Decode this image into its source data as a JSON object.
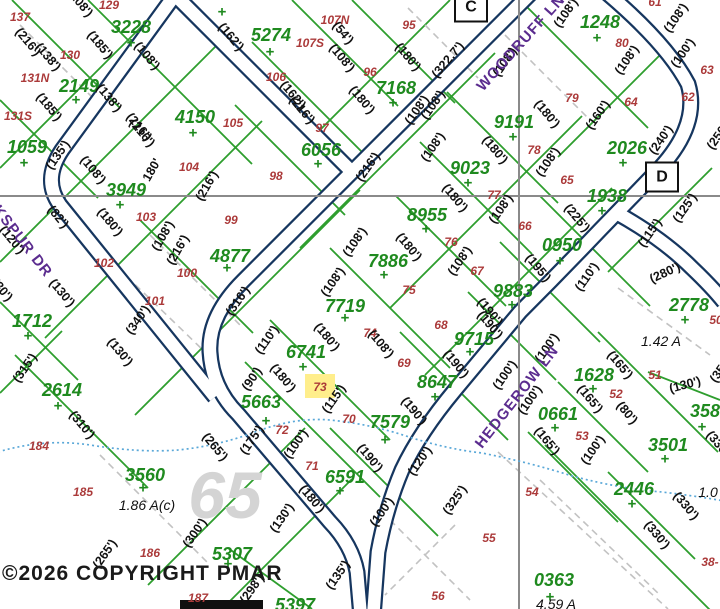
{
  "map": {
    "copyright": "©2026 COPYRIGHT PMAR",
    "watermark": {
      "t": "65",
      "x": 225,
      "y": 495
    },
    "highlighted_lot": "73",
    "colors": {
      "parcel_green_text": "#1f8a1f",
      "parcel_green_line": "#2e9e2e",
      "lot_red": "#ab3a3a",
      "street_purple": "#5b2c8f",
      "road_navy": "#16365f",
      "boundary_gray": "#8a8a8a",
      "stream_blue": "#5aa8d8",
      "highlight_yellow": "#ffee8c"
    },
    "grid_boxes": [
      {
        "t": "C",
        "x": 471,
        "y": 7
      },
      {
        "t": "D",
        "x": 662,
        "y": 177
      }
    ],
    "streets": [
      {
        "name": "WOODRUFF LN",
        "x": 521,
        "y": 43,
        "r": -48
      },
      {
        "name": "LARKSPUR DR",
        "x": 12,
        "y": 228,
        "r": 52
      },
      {
        "name": "HEDGEROW LN",
        "x": 517,
        "y": 397,
        "r": -52
      }
    ],
    "parcels": [
      {
        "n": "3228",
        "x": 131,
        "y": 27,
        "px": 131,
        "py": 43
      },
      {
        "n": "5274",
        "x": 271,
        "y": 35,
        "px": 270,
        "py": 52
      },
      {
        "n": "2149",
        "x": 79,
        "y": 86,
        "px": 76,
        "py": 100
      },
      {
        "n": "4150",
        "x": 195,
        "y": 117,
        "px": 193,
        "py": 133
      },
      {
        "n": "1059",
        "x": 27,
        "y": 147,
        "px": 24,
        "py": 163
      },
      {
        "n": "3949",
        "x": 126,
        "y": 190,
        "px": 120,
        "py": 205
      },
      {
        "n": "6056",
        "x": 321,
        "y": 150,
        "px": 318,
        "py": 164
      },
      {
        "n": "7168",
        "x": 396,
        "y": 88,
        "px": 393,
        "py": 103
      },
      {
        "n": "1248",
        "x": 600,
        "y": 22,
        "px": 597,
        "py": 38
      },
      {
        "n": "9191",
        "x": 514,
        "y": 122,
        "px": 513,
        "py": 137
      },
      {
        "n": "9023",
        "x": 470,
        "y": 168,
        "px": 468,
        "py": 183
      },
      {
        "n": "2026",
        "x": 627,
        "y": 148,
        "px": 623,
        "py": 163
      },
      {
        "n": "1938",
        "x": 607,
        "y": 196,
        "px": 602,
        "py": 211
      },
      {
        "n": "8955",
        "x": 427,
        "y": 215,
        "px": 426,
        "py": 229
      },
      {
        "n": "0950",
        "x": 562,
        "y": 245,
        "px": 560,
        "py": 261
      },
      {
        "n": "7886",
        "x": 388,
        "y": 261,
        "px": 384,
        "py": 275
      },
      {
        "n": "9883",
        "x": 513,
        "y": 291,
        "px": 512,
        "py": 305
      },
      {
        "n": "4877",
        "x": 230,
        "y": 256,
        "px": 227,
        "py": 268
      },
      {
        "n": "2778",
        "x": 689,
        "y": 305,
        "px": 685,
        "py": 320
      },
      {
        "n": "7719",
        "x": 345,
        "y": 306,
        "px": 345,
        "py": 318
      },
      {
        "n": "9715",
        "x": 474,
        "y": 339,
        "px": 470,
        "py": 352
      },
      {
        "n": "6741",
        "x": 306,
        "y": 352,
        "px": 303,
        "py": 367
      },
      {
        "n": "1712",
        "x": 32,
        "y": 321,
        "px": 28,
        "py": 336
      },
      {
        "n": "8647",
        "x": 437,
        "y": 382,
        "px": 435,
        "py": 397
      },
      {
        "n": "1628",
        "x": 594,
        "y": 375,
        "px": 593,
        "py": 389
      },
      {
        "n": "5663",
        "x": 261,
        "y": 402,
        "px": 266,
        "py": 421
      },
      {
        "n": "0661",
        "x": 558,
        "y": 414,
        "px": 555,
        "py": 428
      },
      {
        "n": "3587",
        "x": 710,
        "y": 411,
        "px": 702,
        "py": 427
      },
      {
        "n": "7579",
        "x": 390,
        "y": 422,
        "px": 385,
        "py": 440
      },
      {
        "n": "2614",
        "x": 62,
        "y": 390,
        "px": 58,
        "py": 406
      },
      {
        "n": "3501",
        "x": 668,
        "y": 445,
        "px": 665,
        "py": 459
      },
      {
        "n": "6591",
        "x": 345,
        "y": 477,
        "px": 340,
        "py": 491
      },
      {
        "n": "3560",
        "x": 145,
        "y": 475,
        "px": 143,
        "py": 488
      },
      {
        "n": "2446",
        "x": 634,
        "y": 489,
        "px": 632,
        "py": 504
      },
      {
        "n": "5307",
        "x": 232,
        "y": 554,
        "px": 228,
        "py": 564
      },
      {
        "n": "0363",
        "x": 554,
        "y": 580,
        "px": 550,
        "py": 597
      },
      {
        "n": "5397",
        "x": 295,
        "y": 605,
        "px": -50,
        "py": -50
      }
    ],
    "lone_plus_marks": [
      {
        "x": 222,
        "y": 12
      }
    ],
    "lots": [
      {
        "n": "137",
        "x": 20,
        "y": 17
      },
      {
        "n": "129",
        "x": 109,
        "y": 5
      },
      {
        "n": "130",
        "x": 70,
        "y": 55
      },
      {
        "n": "131N",
        "x": 35,
        "y": 78
      },
      {
        "n": "131S",
        "x": 18,
        "y": 116
      },
      {
        "n": "104",
        "x": 189,
        "y": 167
      },
      {
        "n": "103",
        "x": 146,
        "y": 217
      },
      {
        "n": "102",
        "x": 104,
        "y": 263
      },
      {
        "n": "101",
        "x": 155,
        "y": 301
      },
      {
        "n": "100",
        "x": 187,
        "y": 273
      },
      {
        "n": "99",
        "x": 231,
        "y": 220
      },
      {
        "n": "98",
        "x": 276,
        "y": 176
      },
      {
        "n": "97",
        "x": 322,
        "y": 128
      },
      {
        "n": "96",
        "x": 370,
        "y": 72
      },
      {
        "n": "95",
        "x": 409,
        "y": 25
      },
      {
        "n": "105",
        "x": 233,
        "y": 123
      },
      {
        "n": "106",
        "x": 276,
        "y": 77
      },
      {
        "n": "107N",
        "x": 335,
        "y": 20
      },
      {
        "n": "107S",
        "x": 310,
        "y": 43
      },
      {
        "n": "80",
        "x": 622,
        "y": 43
      },
      {
        "n": "79",
        "x": 572,
        "y": 98
      },
      {
        "n": "78",
        "x": 534,
        "y": 150
      },
      {
        "n": "77",
        "x": 494,
        "y": 195
      },
      {
        "n": "76",
        "x": 451,
        "y": 242
      },
      {
        "n": "75",
        "x": 409,
        "y": 290
      },
      {
        "n": "74",
        "x": 370,
        "y": 333
      },
      {
        "n": "73",
        "x": 320,
        "y": 387
      },
      {
        "n": "72",
        "x": 282,
        "y": 430
      },
      {
        "n": "71",
        "x": 312,
        "y": 466
      },
      {
        "n": "70",
        "x": 349,
        "y": 419
      },
      {
        "n": "69",
        "x": 404,
        "y": 363
      },
      {
        "n": "68",
        "x": 441,
        "y": 325
      },
      {
        "n": "67",
        "x": 477,
        "y": 271
      },
      {
        "n": "66",
        "x": 525,
        "y": 226
      },
      {
        "n": "65",
        "x": 567,
        "y": 180
      },
      {
        "n": "64",
        "x": 631,
        "y": 102
      },
      {
        "n": "63",
        "x": 707,
        "y": 70
      },
      {
        "n": "62",
        "x": 688,
        "y": 97
      },
      {
        "n": "61",
        "x": 655,
        "y": 2
      },
      {
        "n": "50",
        "x": 716,
        "y": 320
      },
      {
        "n": "51",
        "x": 655,
        "y": 375
      },
      {
        "n": "52",
        "x": 616,
        "y": 394
      },
      {
        "n": "53",
        "x": 582,
        "y": 436
      },
      {
        "n": "54",
        "x": 532,
        "y": 492
      },
      {
        "n": "55",
        "x": 489,
        "y": 538
      },
      {
        "n": "56",
        "x": 438,
        "y": 596
      },
      {
        "n": "184",
        "x": 39,
        "y": 446
      },
      {
        "n": "185",
        "x": 83,
        "y": 492
      },
      {
        "n": "186",
        "x": 150,
        "y": 553
      },
      {
        "n": "187",
        "x": 198,
        "y": 598
      },
      {
        "n": "38-",
        "x": 710,
        "y": 562
      }
    ],
    "dims": [
      {
        "t": "(216')",
        "x": 28,
        "y": 42,
        "r": 50
      },
      {
        "t": "(138')",
        "x": 48,
        "y": 57,
        "r": 50
      },
      {
        "t": "(185')",
        "x": 100,
        "y": 45,
        "r": 50
      },
      {
        "t": "(108')",
        "x": 147,
        "y": 56,
        "r": 50
      },
      {
        "t": "(185')",
        "x": 49,
        "y": 107,
        "r": 50
      },
      {
        "t": "(138')",
        "x": 109,
        "y": 98,
        "r": 50
      },
      {
        "t": "(216')",
        "x": 139,
        "y": 127,
        "r": 50
      },
      {
        "t": "(135')",
        "x": 58,
        "y": 155,
        "r": -55
      },
      {
        "t": "(108')",
        "x": 93,
        "y": 170,
        "r": 50
      },
      {
        "t": "180'",
        "x": 152,
        "y": 170,
        "r": -60
      },
      {
        "t": "(216')",
        "x": 207,
        "y": 186,
        "r": -60
      },
      {
        "t": "(216')",
        "x": 142,
        "y": 133,
        "r": 50
      },
      {
        "t": "(162')",
        "x": 231,
        "y": 37,
        "r": 50
      },
      {
        "t": "(108')",
        "x": 80,
        "y": 3,
        "r": 50
      },
      {
        "t": "(54')",
        "x": 343,
        "y": 33,
        "r": 50
      },
      {
        "t": "(108')",
        "x": 342,
        "y": 58,
        "r": 50
      },
      {
        "t": "(180')",
        "x": 408,
        "y": 57,
        "r": 50
      },
      {
        "t": "(180')",
        "x": 362,
        "y": 100,
        "r": 50
      },
      {
        "t": "(108')",
        "x": 417,
        "y": 110,
        "r": -55
      },
      {
        "t": "(162')",
        "x": 293,
        "y": 95,
        "r": 50
      },
      {
        "t": "(216')",
        "x": 302,
        "y": 110,
        "r": 50
      },
      {
        "t": "(216')",
        "x": 368,
        "y": 167,
        "r": -55
      },
      {
        "t": "(108')",
        "x": 433,
        "y": 147,
        "r": -55
      },
      {
        "t": "(120')",
        "x": 12,
        "y": 240,
        "r": 50
      },
      {
        "t": "(82')",
        "x": 58,
        "y": 217,
        "r": 50
      },
      {
        "t": "(180')",
        "x": 110,
        "y": 222,
        "r": 50
      },
      {
        "t": "(216')",
        "x": 178,
        "y": 250,
        "r": -60
      },
      {
        "t": "(108')",
        "x": 163,
        "y": 236,
        "r": -60
      },
      {
        "t": "(130')",
        "x": 62,
        "y": 293,
        "r": 50
      },
      {
        "t": "(340')",
        "x": 138,
        "y": 320,
        "r": -55
      },
      {
        "t": "(316')",
        "x": 238,
        "y": 301,
        "r": -55
      },
      {
        "t": "(130')",
        "x": 120,
        "y": 352,
        "r": 50
      },
      {
        "t": "(315')",
        "x": 25,
        "y": 368,
        "r": -55
      },
      {
        "t": "(310')",
        "x": 82,
        "y": 425,
        "r": 50
      },
      {
        "t": "(265')",
        "x": 215,
        "y": 447,
        "r": 50
      },
      {
        "t": "(30')",
        "x": 2,
        "y": 290,
        "r": 50
      },
      {
        "t": "(322.7')",
        "x": 448,
        "y": 60,
        "r": -50
      },
      {
        "t": "(108')",
        "x": 505,
        "y": 62,
        "r": -55
      },
      {
        "t": "(108')",
        "x": 566,
        "y": 13,
        "r": -55
      },
      {
        "t": "(108')",
        "x": 627,
        "y": 60,
        "r": -55
      },
      {
        "t": "(108')",
        "x": 676,
        "y": 18,
        "r": -55
      },
      {
        "t": "(100')",
        "x": 683,
        "y": 53,
        "r": -55
      },
      {
        "t": "(240')",
        "x": 661,
        "y": 140,
        "r": -55
      },
      {
        "t": "(250')",
        "x": 719,
        "y": 135,
        "r": -55
      },
      {
        "t": "(160')",
        "x": 598,
        "y": 115,
        "r": -55
      },
      {
        "t": "(180')",
        "x": 547,
        "y": 114,
        "r": 50
      },
      {
        "t": "(180')",
        "x": 495,
        "y": 150,
        "r": 50
      },
      {
        "t": "(108')",
        "x": 433,
        "y": 105,
        "r": -55
      },
      {
        "t": "(108')",
        "x": 548,
        "y": 162,
        "r": -55
      },
      {
        "t": "(180')",
        "x": 455,
        "y": 198,
        "r": 50
      },
      {
        "t": "(108')",
        "x": 501,
        "y": 209,
        "r": -55
      },
      {
        "t": "(180')",
        "x": 409,
        "y": 247,
        "r": 50
      },
      {
        "t": "(108')",
        "x": 460,
        "y": 261,
        "r": -55
      },
      {
        "t": "(225')",
        "x": 577,
        "y": 218,
        "r": 50
      },
      {
        "t": "(115')",
        "x": 650,
        "y": 233,
        "r": -55
      },
      {
        "t": "(125')",
        "x": 685,
        "y": 208,
        "r": -55
      },
      {
        "t": "(195')",
        "x": 538,
        "y": 268,
        "r": 50
      },
      {
        "t": "(110')",
        "x": 587,
        "y": 277,
        "r": -55
      },
      {
        "t": "(280')",
        "x": 665,
        "y": 273,
        "r": -25
      },
      {
        "t": "(190')",
        "x": 490,
        "y": 325,
        "r": 50
      },
      {
        "t": "(100')",
        "x": 547,
        "y": 348,
        "r": -55
      },
      {
        "t": "(100')",
        "x": 505,
        "y": 375,
        "r": -55
      },
      {
        "t": "(108')",
        "x": 355,
        "y": 242,
        "r": -55
      },
      {
        "t": "(108')",
        "x": 333,
        "y": 282,
        "r": -55
      },
      {
        "t": "(180')",
        "x": 327,
        "y": 337,
        "r": 50
      },
      {
        "t": "(110')",
        "x": 267,
        "y": 340,
        "r": -55
      },
      {
        "t": "(90')",
        "x": 252,
        "y": 379,
        "r": -55
      },
      {
        "t": "(180')",
        "x": 283,
        "y": 378,
        "r": 50
      },
      {
        "t": "(108')",
        "x": 381,
        "y": 344,
        "r": 50
      },
      {
        "t": "(190')",
        "x": 456,
        "y": 364,
        "r": 50
      },
      {
        "t": "(190')",
        "x": 490,
        "y": 312,
        "r": 50
      },
      {
        "t": "(190')",
        "x": 414,
        "y": 411,
        "r": 50
      },
      {
        "t": "(190')",
        "x": 370,
        "y": 458,
        "r": 50
      },
      {
        "t": "(115')",
        "x": 334,
        "y": 399,
        "r": -55
      },
      {
        "t": "(175')",
        "x": 252,
        "y": 440,
        "r": -55
      },
      {
        "t": "(100')",
        "x": 296,
        "y": 444,
        "r": -55
      },
      {
        "t": "(120')",
        "x": 420,
        "y": 461,
        "r": -55
      },
      {
        "t": "(325')",
        "x": 455,
        "y": 500,
        "r": -55
      },
      {
        "t": "(100')",
        "x": 382,
        "y": 512,
        "r": -55
      },
      {
        "t": "(130')",
        "x": 282,
        "y": 518,
        "r": -55
      },
      {
        "t": "(180')",
        "x": 312,
        "y": 499,
        "r": 50
      },
      {
        "t": "(135')",
        "x": 338,
        "y": 575,
        "r": -55
      },
      {
        "t": "(298')",
        "x": 252,
        "y": 589,
        "r": -55
      },
      {
        "t": "(265')",
        "x": 105,
        "y": 554,
        "r": -55
      },
      {
        "t": "(300')",
        "x": 195,
        "y": 533,
        "r": -55
      },
      {
        "t": "(165')",
        "x": 547,
        "y": 441,
        "r": 50
      },
      {
        "t": "(165')",
        "x": 620,
        "y": 365,
        "r": 50
      },
      {
        "t": "(165')",
        "x": 590,
        "y": 399,
        "r": 50
      },
      {
        "t": "(100')",
        "x": 593,
        "y": 450,
        "r": -55
      },
      {
        "t": "(100')",
        "x": 530,
        "y": 400,
        "r": -55
      },
      {
        "t": "(80')",
        "x": 627,
        "y": 413,
        "r": 50
      },
      {
        "t": "(130')",
        "x": 685,
        "y": 385,
        "r": -15
      },
      {
        "t": "(350')",
        "x": 722,
        "y": 368,
        "r": -55
      },
      {
        "t": "(330')",
        "x": 686,
        "y": 506,
        "r": 50
      },
      {
        "t": "(330')",
        "x": 657,
        "y": 535,
        "r": 50
      },
      {
        "t": "(330')",
        "x": 719,
        "y": 445,
        "r": 50
      }
    ],
    "areas": [
      {
        "t": "1.42 A",
        "x": 661,
        "y": 341
      },
      {
        "t": "1.86 A(c)",
        "x": 147,
        "y": 505
      },
      {
        "t": "4.59 A",
        "x": 556,
        "y": 604
      },
      {
        "t": "1.0",
        "x": 708,
        "y": 492
      }
    ]
  }
}
